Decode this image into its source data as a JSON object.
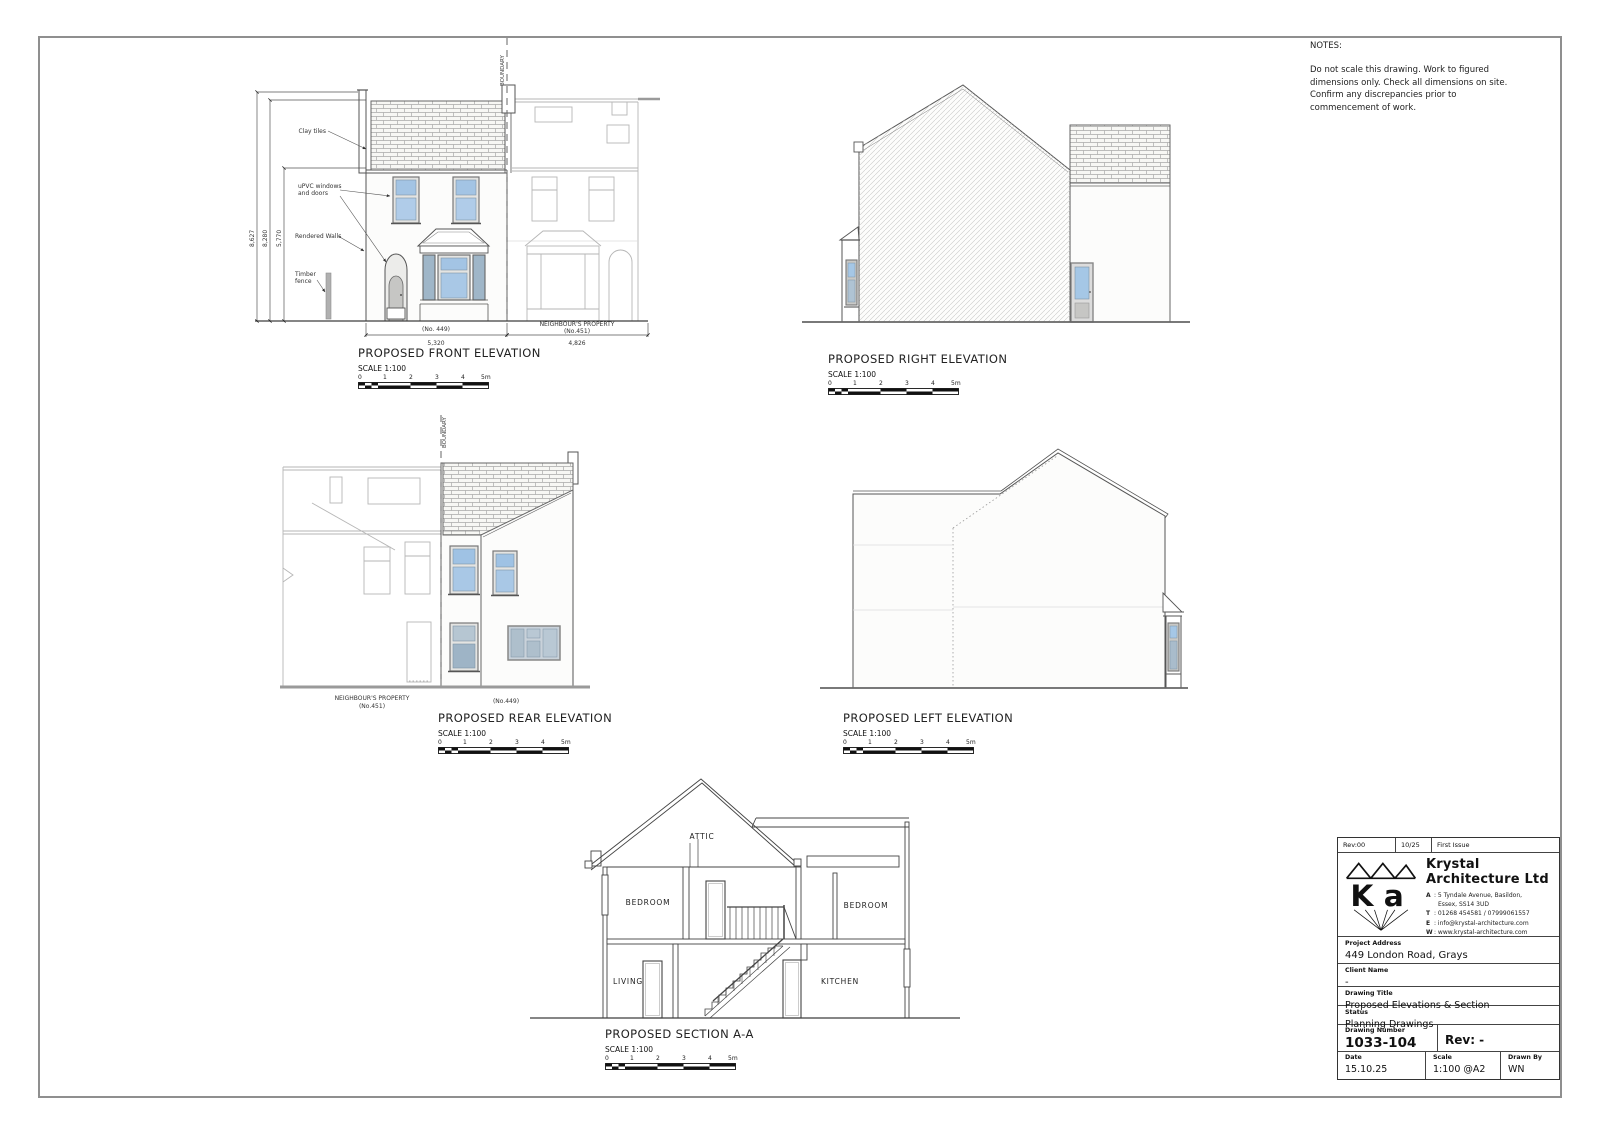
{
  "notes": {
    "title": "NOTES:",
    "body": "Do not scale this drawing. Work to figured dimensions only. Check all dimensions on site. Confirm any discrepancies prior to commencement of work."
  },
  "scalebar": {
    "ticks": [
      "0",
      "1",
      "2",
      "3",
      "4",
      "5m"
    ]
  },
  "colors": {
    "glazing_blue": "#a5c6e5",
    "glazing_grey": "#9fb6c8",
    "line_dark": "#444444",
    "line_neighbour": "#b4b4b4"
  },
  "front": {
    "title": "PROPOSED FRONT ELEVATION",
    "scale": "SCALE 1:100",
    "boundary": "BOUNDARY",
    "labels": {
      "clay_tiles": "Clay tiles",
      "upvc_1": "uPVC windows",
      "upvc_2": "and doors",
      "rendered": "Rendered Walls",
      "timber_1": "Timber",
      "timber_2": "fence"
    },
    "dims": {
      "h_total": "8,627",
      "h_ridge": "8,280",
      "h_eaves": "5,770",
      "w_house": "5,320",
      "w_neigh": "4,826"
    },
    "house_no": "(No. 449)",
    "neigh_1": "NEIGHBOUR'S PROPERTY",
    "neigh_2": "(No.451)"
  },
  "right": {
    "title": "PROPOSED RIGHT ELEVATION",
    "scale": "SCALE 1:100"
  },
  "rear": {
    "title": "PROPOSED REAR ELEVATION",
    "scale": "SCALE 1:100",
    "boundary": "BOUNDARY",
    "neigh_1": "NEIGHBOUR'S PROPERTY",
    "neigh_2": "(No.451)",
    "house_no": "(No.449)"
  },
  "left": {
    "title": "PROPOSED LEFT ELEVATION",
    "scale": "SCALE 1:100"
  },
  "section": {
    "title": "PROPOSED SECTION A-A",
    "scale": "SCALE 1:100",
    "rooms": {
      "attic": "ATTIC",
      "bedroom_l": "BEDROOM",
      "bedroom_r": "BEDROOM",
      "living": "LIVING",
      "kitchen": "KITCHEN"
    }
  },
  "titleblock": {
    "rev_label": "Rev:00",
    "rev_date": "10/25",
    "rev_desc": "First Issue",
    "logo_k": "K",
    "logo_a": "a",
    "company_1": "Krystal",
    "company_2": "Architecture Ltd",
    "addr_a_k": "A",
    "addr_a_v": ": 5 Tyndale Avenue, Basildon,",
    "addr_a_v2": "Essex, SS14 3UD",
    "addr_t_k": "T",
    "addr_t_v": ": 01268 454581 / 07999061557",
    "addr_e_k": "E",
    "addr_e_v": ": info@krystal-architecture.com",
    "addr_w_k": "W",
    "addr_w_v": ": www.krystal-architecture.com",
    "project_label": "Project Address",
    "project_value": "449 London Road, Grays",
    "client_label": "Client Name",
    "client_value": "-",
    "drawing_title_label": "Drawing Title",
    "drawing_title_value": "Proposed Elevations & Section",
    "status_label": "Status",
    "status_value": "Planning Drawings",
    "number_label": "Drawing Number",
    "number_value": "1033-104",
    "rev_value": "Rev: -",
    "date_label": "Date",
    "date_value": "15.10.25",
    "scale_label": "Scale",
    "scale_value": "1:100 @A2",
    "drawn_label": "Drawn By",
    "drawn_value": "WN"
  }
}
